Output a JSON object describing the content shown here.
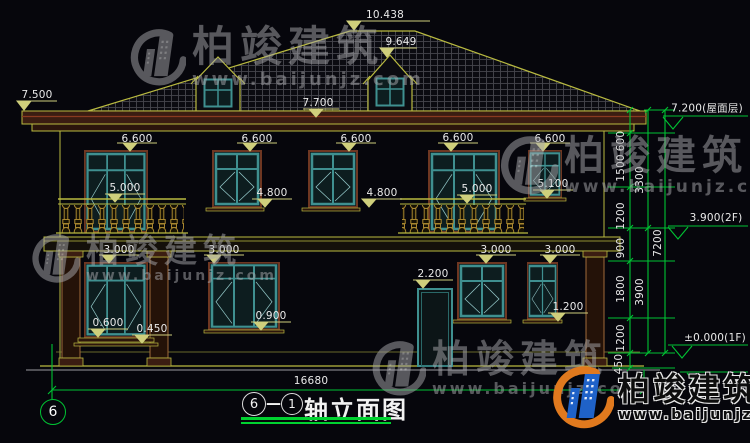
{
  "title_block": {
    "axis_from": "6",
    "separator": "—",
    "axis_to": "1",
    "label": "轴立面图"
  },
  "axis_bubble": {
    "label": "6"
  },
  "watermark": {
    "brand": "柏竣建筑",
    "url": "www.baijunjz.com"
  },
  "colors": {
    "background": "#06060c",
    "line_yellow": "#b9ba40",
    "dim_green": "#00c333",
    "window_teal": "#3f9090",
    "logo_blue": "#1f62c8",
    "logo_orange": "#e0791e"
  },
  "annotations": [
    {
      "text": "10.438",
      "x": 385,
      "y": 15
    },
    {
      "text": "9.649",
      "x": 401,
      "y": 42
    },
    {
      "text": "7.700",
      "x": 318,
      "y": 103
    },
    {
      "text": "7.500",
      "x": 37,
      "y": 95
    },
    {
      "text": "6.600",
      "x": 137,
      "y": 139
    },
    {
      "text": "6.600",
      "x": 257,
      "y": 139
    },
    {
      "text": "6.600",
      "x": 356,
      "y": 139
    },
    {
      "text": "6.600",
      "x": 458,
      "y": 138
    },
    {
      "text": "6.600",
      "x": 550,
      "y": 139
    },
    {
      "text": "5.000",
      "x": 125,
      "y": 188
    },
    {
      "text": "4.800",
      "x": 272,
      "y": 193
    },
    {
      "text": "4.800",
      "x": 382,
      "y": 193
    },
    {
      "text": "5.000",
      "x": 477,
      "y": 189
    },
    {
      "text": "5.100",
      "x": 553,
      "y": 184
    },
    {
      "text": "3.000",
      "x": 119,
      "y": 250
    },
    {
      "text": "3.000",
      "x": 224,
      "y": 250
    },
    {
      "text": "3.000",
      "x": 496,
      "y": 250
    },
    {
      "text": "3.000",
      "x": 560,
      "y": 250
    },
    {
      "text": "2.200",
      "x": 433,
      "y": 274
    },
    {
      "text": "0.900",
      "x": 271,
      "y": 316
    },
    {
      "text": "1.200",
      "x": 568,
      "y": 307
    },
    {
      "text": "0.600",
      "x": 108,
      "y": 323
    },
    {
      "text": "0.450",
      "x": 152,
      "y": 329
    },
    {
      "text": "16680",
      "x": 311,
      "y": 381
    },
    {
      "text": "7.200(屋面层)",
      "x": 707,
      "y": 108
    },
    {
      "text": "3.900(2F)",
      "x": 716,
      "y": 218
    },
    {
      "text": "±0.000(1F)",
      "x": 715,
      "y": 338
    },
    {
      "text": "600",
      "x": 621,
      "y": 141,
      "vertical": true
    },
    {
      "text": "1500",
      "x": 621,
      "y": 168,
      "vertical": true
    },
    {
      "text": "3300",
      "x": 640,
      "y": 180,
      "vertical": true
    },
    {
      "text": "1200",
      "x": 621,
      "y": 216,
      "vertical": true
    },
    {
      "text": "900",
      "x": 621,
      "y": 248,
      "vertical": true
    },
    {
      "text": "7200",
      "x": 658,
      "y": 243,
      "vertical": true
    },
    {
      "text": "1800",
      "x": 621,
      "y": 289,
      "vertical": true
    },
    {
      "text": "3900",
      "x": 640,
      "y": 292,
      "vertical": true
    },
    {
      "text": "1200",
      "x": 621,
      "y": 338,
      "vertical": true
    },
    {
      "text": "450",
      "x": 619,
      "y": 364,
      "vertical": true
    }
  ]
}
